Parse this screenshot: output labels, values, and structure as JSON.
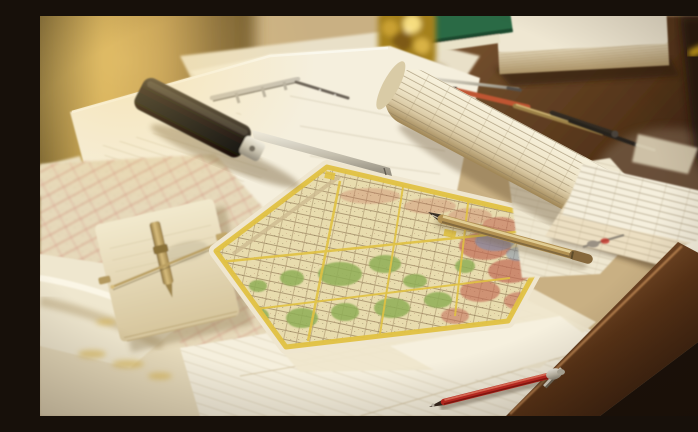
{
  "meta": {
    "title": "Photograph of an architect's wooden desk covered with city street maps, blueprints, a rolled plan scroll, drafting tools and pens in warm golden light"
  },
  "palette": {
    "paper_white": "#f5efdd",
    "paper_cream": "#eadfc2",
    "map_base": "#e8dcae",
    "map_green": "#8fae56",
    "map_red": "#c16a55",
    "map_yellow": "#e0c142",
    "map_blue": "#7e8fae",
    "pen_red": "#c32a22",
    "pen_gold": "#b29152",
    "scroll_core_red": "#8e2720",
    "book_green": "#2c6b44",
    "book_cream": "#efe7d2",
    "brass": "#d9b244",
    "wood_desk": "#6e4c2c",
    "wood_dark": "#1a110a",
    "tool_black": "#15100c",
    "steel": "#cfcabc",
    "window_glow": "#d4ae55"
  },
  "scene": {
    "objects": [
      {
        "id": "background-light",
        "label": "Blurred warm interior with golden window light"
      },
      {
        "id": "desk",
        "label": "Dark wooden drafting desk"
      },
      {
        "id": "blueprint-sheet",
        "label": "Large pale blueprint sheet"
      },
      {
        "id": "marking-gauge",
        "label": "Black marking gauge with steel beam ruler"
      },
      {
        "id": "caliper",
        "label": "Steel caliper"
      },
      {
        "id": "brass-ornament",
        "label": "Ornate polished brass instrument"
      },
      {
        "id": "green-book",
        "label": "Green hardcover notebook"
      },
      {
        "id": "cream-book",
        "label": "Thick book with cream page block"
      },
      {
        "id": "yellow-pencil",
        "label": "Blurred yellow pencil"
      },
      {
        "id": "scroll",
        "label": "Rolled plan scroll with printed tables and red core"
      },
      {
        "id": "dividers",
        "label": "Drafting dividers and pencils"
      },
      {
        "id": "city-map",
        "label": "Colored city street map with green parks and yellow border"
      },
      {
        "id": "left-maps",
        "label": "Street maps with red road lines"
      },
      {
        "id": "notepad",
        "label": "Notepad with brass ruling pen"
      },
      {
        "id": "gold-pen",
        "label": "Vintage brass pen"
      },
      {
        "id": "red-pen",
        "label": "Red ballpoint pen with silver clip"
      },
      {
        "id": "right-sheets",
        "label": "Survey sheets overhanging the desk edge"
      },
      {
        "id": "bottom-sheets",
        "label": "Scattered drawing sheets"
      },
      {
        "id": "desk-edge",
        "label": "Polished desk edge over dark shadow"
      },
      {
        "id": "red-tool",
        "label": "Small drafting nib with red tip"
      }
    ]
  }
}
